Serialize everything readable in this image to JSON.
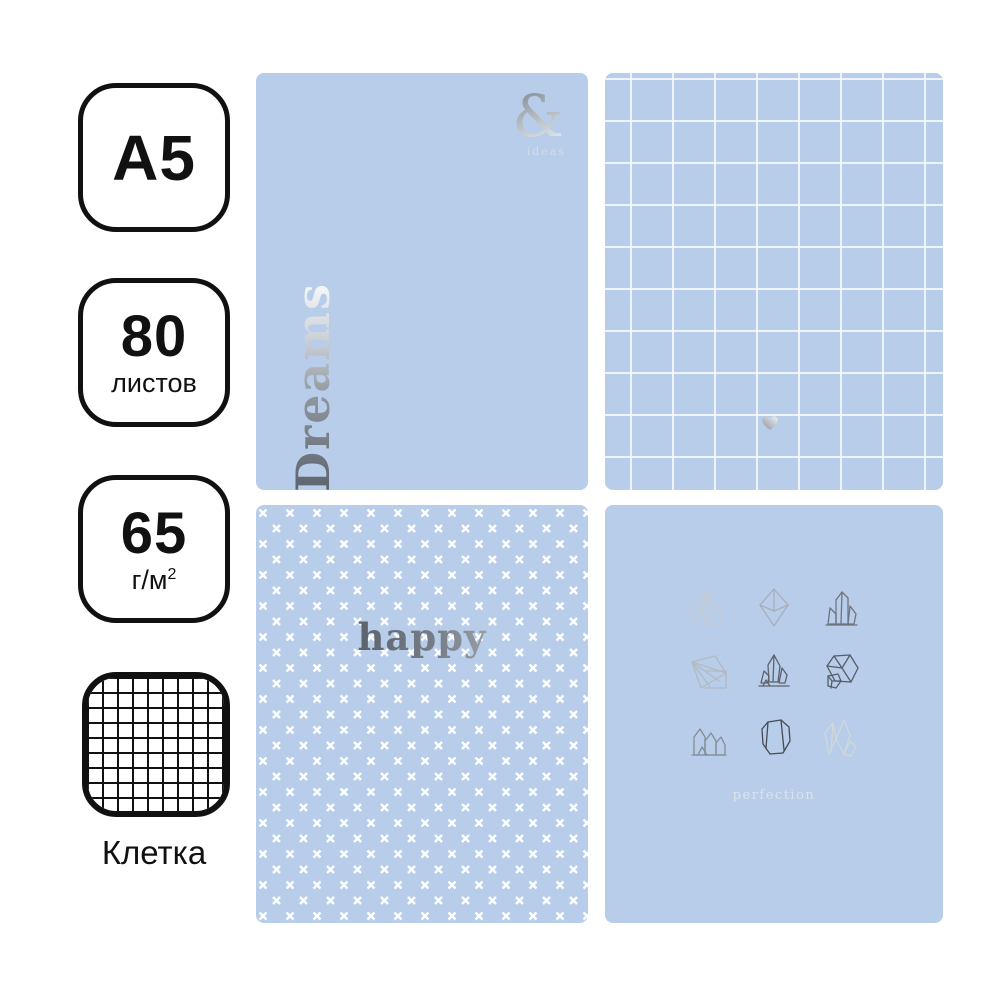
{
  "product": {
    "type": "notebook-covers-set",
    "colors": {
      "cover_blue": "#b7cde9",
      "pattern_white": "#ffffff",
      "foil_dark": "#5d636c",
      "foil_light": "#f2f3f5",
      "badge_border": "#111111"
    }
  },
  "spec_badges": {
    "format": {
      "label": "A5"
    },
    "sheets": {
      "value": "80",
      "unit": "листов"
    },
    "density": {
      "value": "65",
      "unit": "г/м",
      "unit_sup": "2"
    },
    "ruling": {
      "icon": "grid-squares",
      "caption": "Клетка"
    }
  },
  "covers": {
    "dreams": {
      "pattern": "plain",
      "title": "Dreams",
      "ampersand": "&",
      "subtitle": "ideas"
    },
    "grid": {
      "pattern": "white-grid",
      "icon": "heart"
    },
    "happy": {
      "pattern": "white-crosses",
      "title": "happy"
    },
    "perfection": {
      "pattern": "crystal-drawings",
      "crystal_count": 9,
      "caption": "perfection"
    }
  }
}
